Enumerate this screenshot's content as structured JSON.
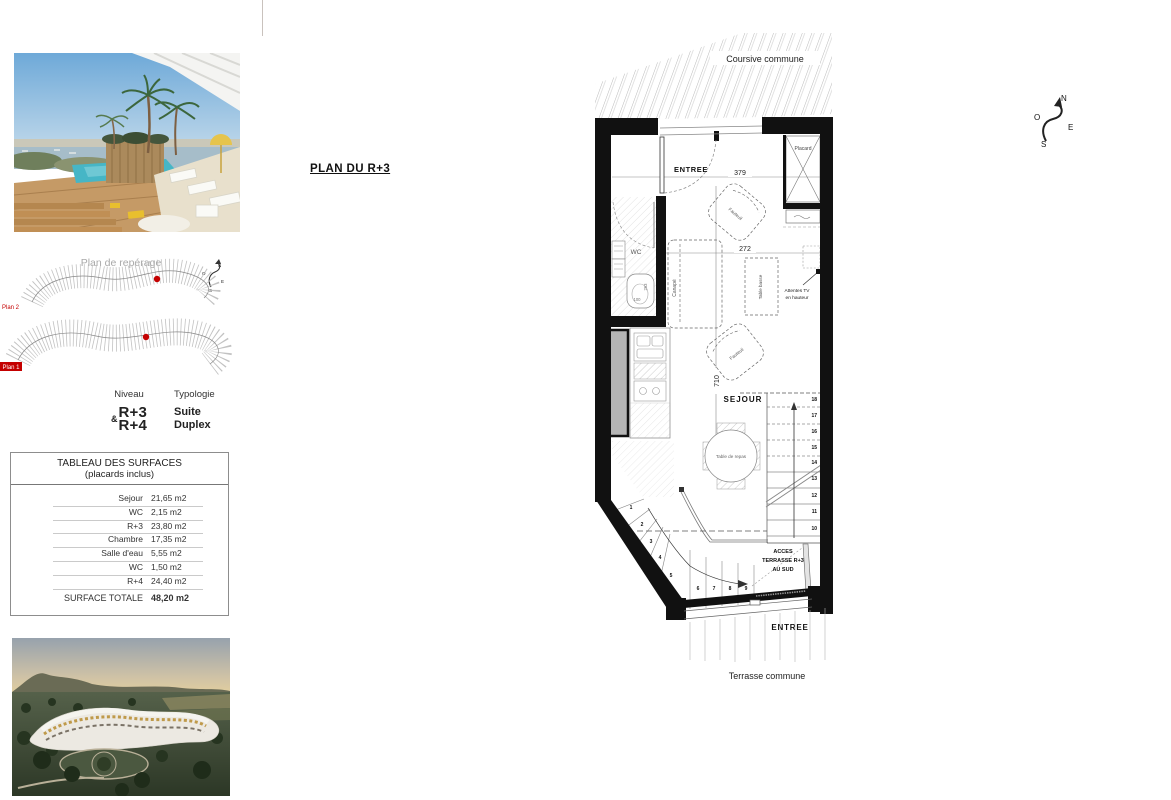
{
  "colors": {
    "accent_red": "#c40000",
    "wall_black": "#111111",
    "paper": "#ffffff",
    "pool_teal": "#46b6c6"
  },
  "page_title": "PLAN DU R+3",
  "compass": {
    "n": "N",
    "o": "O",
    "e": "E",
    "s": "S"
  },
  "reperage": {
    "title": "Plan de repérage",
    "plan1": "Plan 1",
    "plan2": "Plan 2"
  },
  "level": {
    "niveau_label": "Niveau",
    "typologie_label": "Typologie",
    "amp": "&",
    "level1": "R+3",
    "level2": "R+4",
    "typo1": "Suite",
    "typo2": "Duplex"
  },
  "surfaces": {
    "title": "TABLEAU DES SURFACES",
    "subtitle": "(placards inclus)",
    "rows": [
      {
        "label": "Sejour",
        "value": "21,65 m2"
      },
      {
        "label": "WC",
        "value": "2,15 m2"
      },
      {
        "label": "R+3",
        "value": "23,80 m2"
      },
      {
        "label": "Chambre",
        "value": "17,35 m2"
      },
      {
        "label": "Salle d'eau",
        "value": "5,55 m2"
      },
      {
        "label": "WC",
        "value": "1,50 m2"
      },
      {
        "label": "R+4",
        "value": "24,40 m2"
      }
    ],
    "total_label": "SURFACE TOTALE",
    "total_value": "48,20 m2"
  },
  "plan": {
    "coursive": "Coursive commune",
    "terrasse": "Terrasse commune",
    "entree_top": "ENTREE",
    "entree_bottom": "ENTREE",
    "sejour": "SEJOUR",
    "wc": "WC",
    "placard": "Placard",
    "canape": "Canapé",
    "table_basse": "Table basse",
    "fauteuil_a": "Fauteuil",
    "fauteuil_b": "Fauteuil",
    "table_repas": "Table de repas",
    "tv_line1": "Attentes TV",
    "tv_line2": "en hauteur",
    "acces1": "ACCES",
    "acces2": "TERRASSE R+3",
    "acces3": "AU SUD",
    "dim_379": "379",
    "dim_272": "272",
    "dim_710": "710",
    "dim_100": "100",
    "dim_263": "263",
    "stairs_right": [
      "18",
      "17",
      "16",
      "15",
      "14",
      "13",
      "12",
      "11",
      "10"
    ],
    "stairs_winder": [
      "1",
      "2",
      "3",
      "4",
      "5",
      "6",
      "7",
      "8",
      "9"
    ]
  }
}
